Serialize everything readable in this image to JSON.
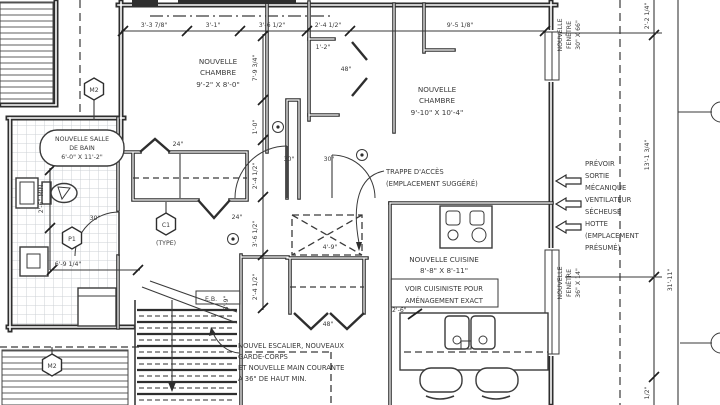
{
  "colors": {
    "ink": "#3a3a3a",
    "wall": "#2e2e2e",
    "paper": "#ffffff",
    "tile": "#ccd1d6"
  },
  "rooms": {
    "chambre1": {
      "line1": "NOUVELLE",
      "line2": "CHAMBRE",
      "line3": "9'-2\" X 8'-0\""
    },
    "chambre2": {
      "line1": "NOUVELLE",
      "line2": "CHAMBRE",
      "line3": "9'-10\" X 10'-4\""
    },
    "salle_de_bain": {
      "line1": "NOUVELLE SALLE",
      "line2": "DE BAIN",
      "line3": "6'-0\" X 11'-2\""
    },
    "cuisine": {
      "line1": "NOUVELLE CUISINE",
      "line2": "8'-8\" X 8'-11\""
    }
  },
  "annotations": {
    "cuisiniste": {
      "line1": "VOIR CUISINISTE POUR",
      "line2": "AMÉNAGEMENT EXACT"
    },
    "trappe": {
      "line1": "TRAPPE D'ACCÈS",
      "line2": "(EMPLACEMENT SUGGÉRÉ)"
    },
    "escalier": {
      "line1": "NOUVEL ESCALIER, NOUVEAUX",
      "line2": "GARDE-CORPS",
      "line3": "ET NOUVELLE MAIN COURANTE",
      "line4": "À 36\" DE HAUT MIN."
    },
    "mecanique": {
      "line1": "PRÉVOIR",
      "line2": "SORTIE",
      "line3": "MÉCANIQUE",
      "line4": "VENTILATEUR",
      "line5": "SÉCHEUSE",
      "line6": "HOTTE",
      "line7": "(EMPLACEMENT",
      "line8": "PRÉSUMÉ)"
    },
    "fenetre_haut": {
      "line1": "NOUVELLE",
      "line2": "FENÊTRE",
      "line3": "30\" X 66\""
    },
    "fenetre_bas": {
      "line1": "NOUVELLE",
      "line2": "FENÊTRE",
      "line3": "36\" X 14\""
    },
    "eb": "E.B."
  },
  "dimensions": {
    "top": [
      "3'-3 7/8\"",
      "3'-1\"",
      "3'-6 1/2\"",
      "2'-4 1/2\"",
      "9'-5 1/8\""
    ],
    "interior_chain": [
      "7'-9 3/4\"",
      "1'-0\"",
      "2'-4 1/2\"",
      "3'-6 1/2\"",
      "2'-4 1/2\""
    ],
    "right": [
      "2'-2 1/4\"",
      "13'-1 3/4\"",
      "31'-11\"",
      "1/2\""
    ],
    "bathroom_clearance": "2'-6\" MIN.",
    "bathroom_width": "6'-9 1/4\"",
    "hatch": "4'-9\"",
    "counter": "2'-6\"",
    "stair": "3'-9\"",
    "wall_jog": "1'-2\""
  },
  "door_labels": {
    "d24": "24\"",
    "d30": "30\"",
    "d48": "48\""
  },
  "symbols": {
    "m2": "M2",
    "c1": "C1",
    "c1_type": "(TYPE)",
    "p1": "P1"
  }
}
